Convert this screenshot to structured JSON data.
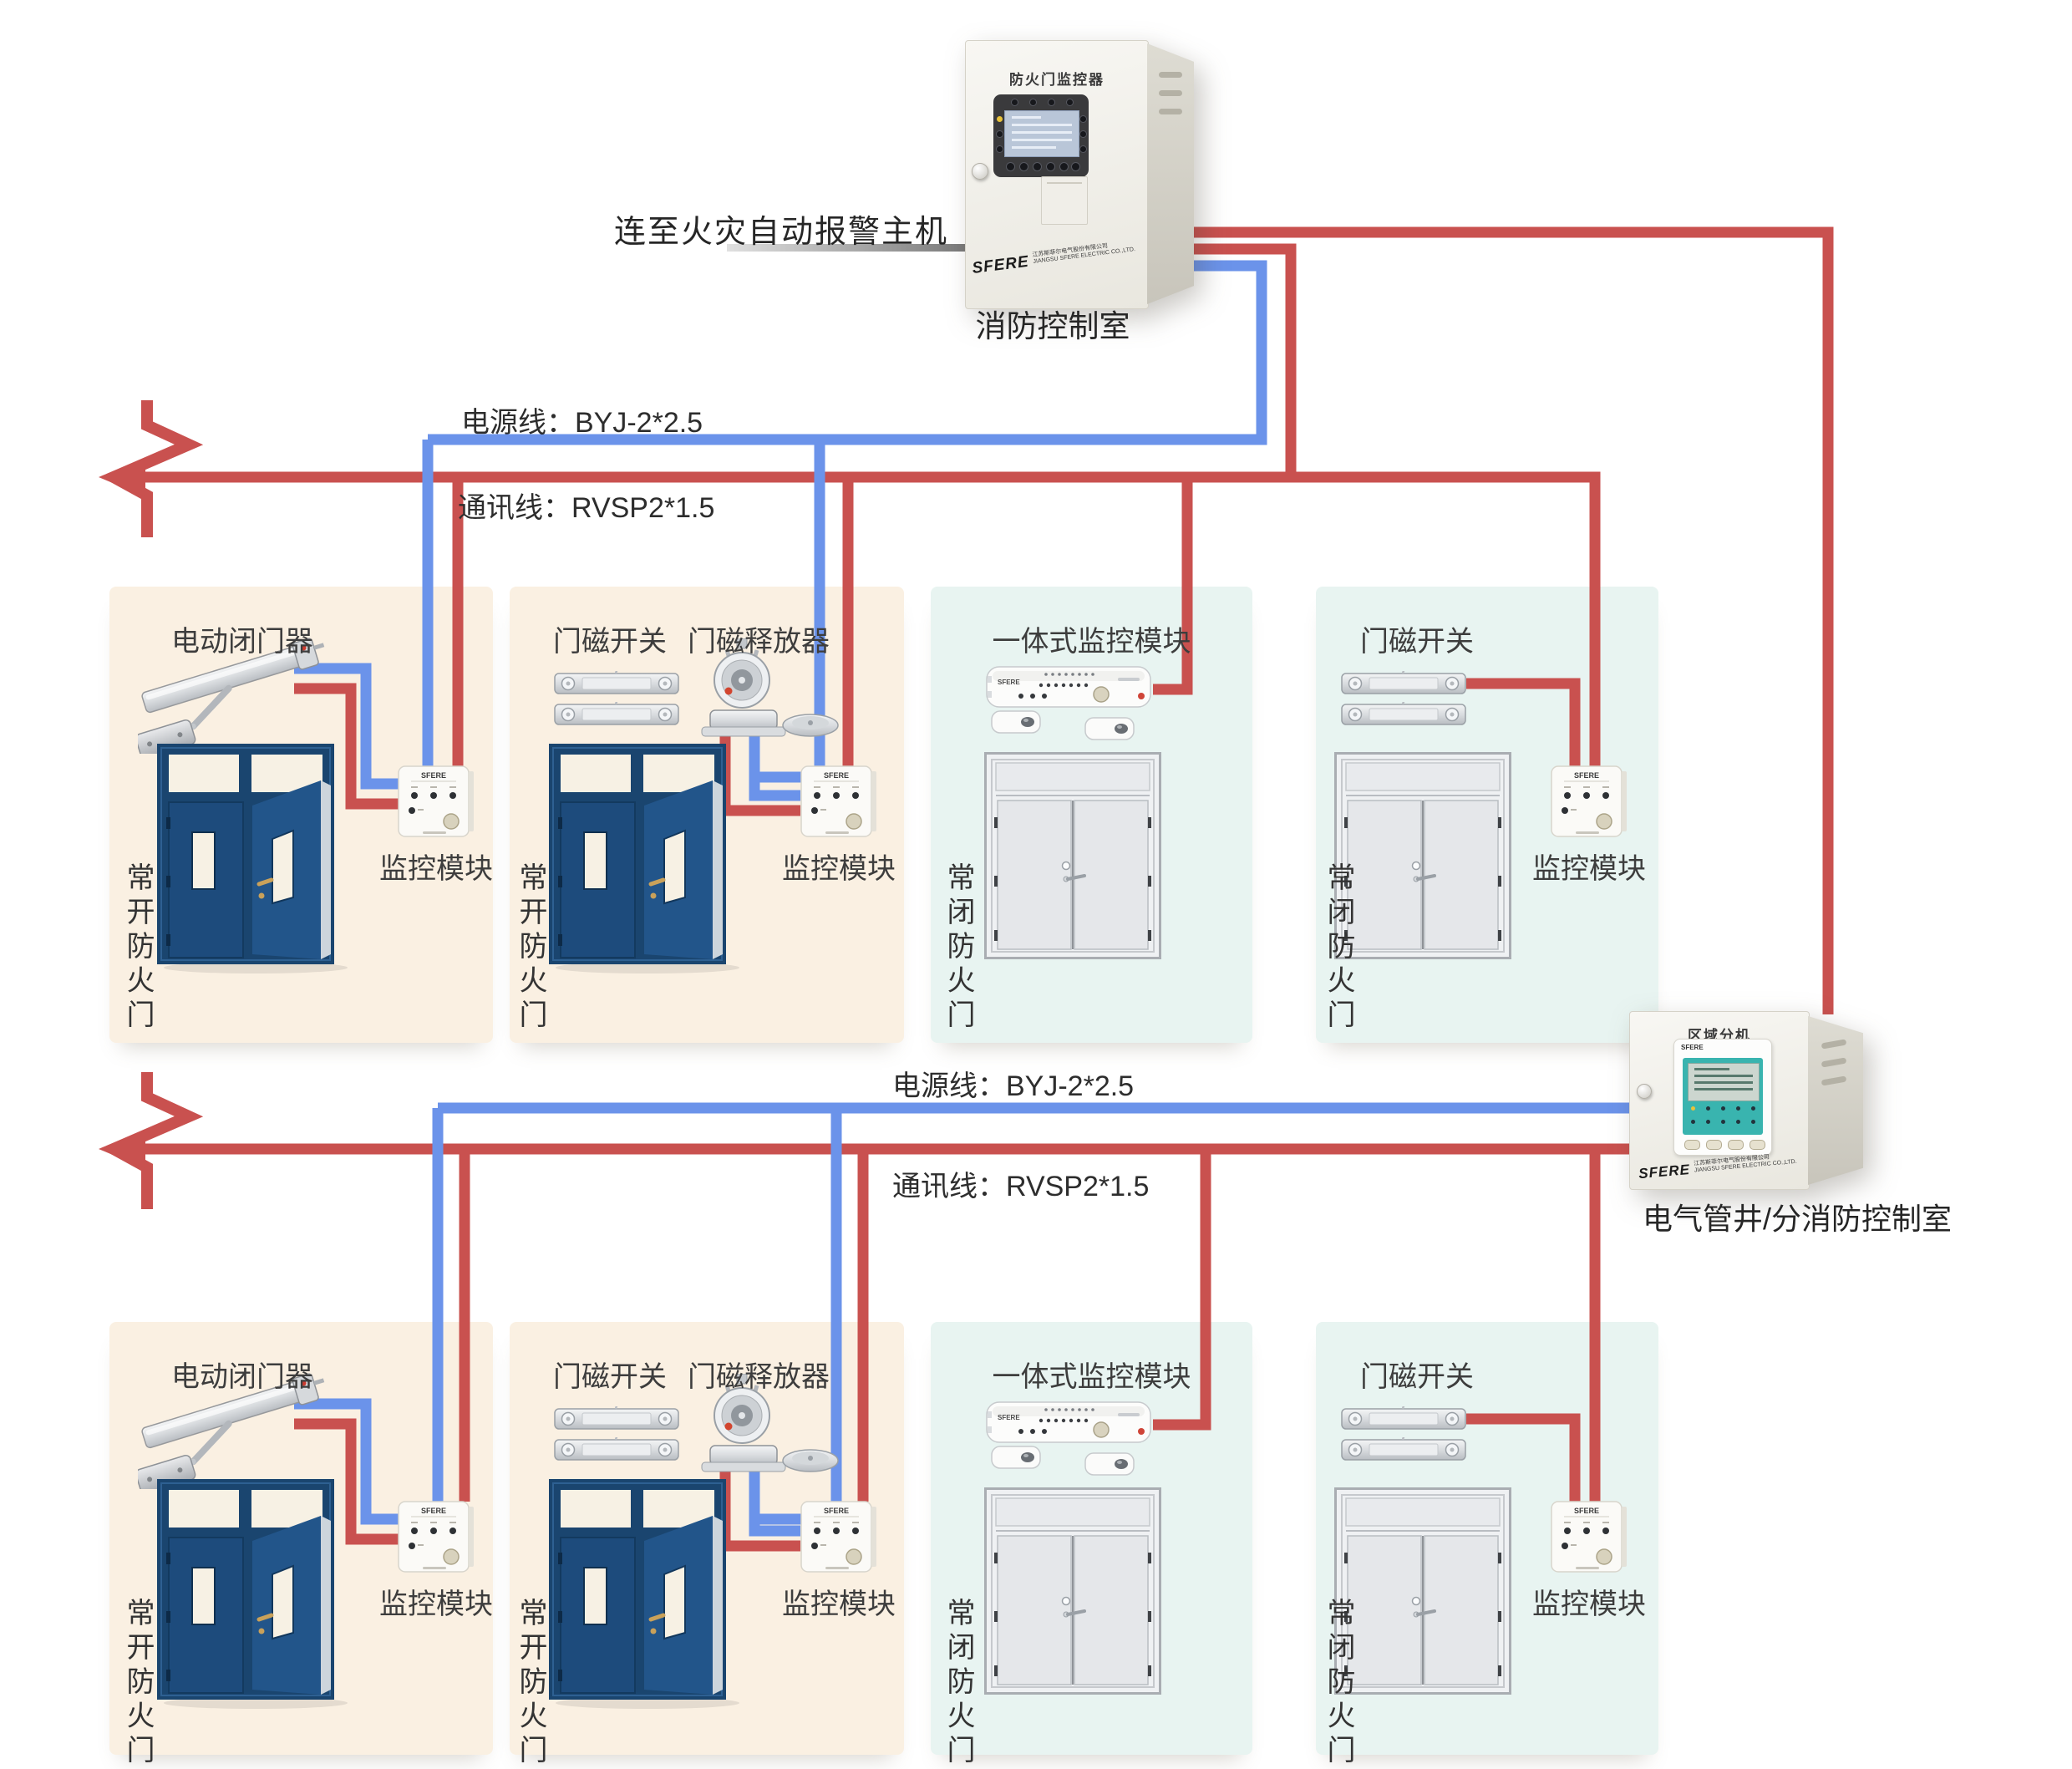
{
  "colors": {
    "wire_red": "#c9514f",
    "wire_blue": "#6b93ea",
    "panel_warm": "#faf0e2",
    "panel_cool": "#e8f4f1",
    "door_navy": "#1d4b7c",
    "door_gray": "#eff1f3",
    "screen_teal": "#39b4af"
  },
  "brand": {
    "name": "SFERE"
  },
  "top": {
    "alarm_link_label": "连至火灾自动报警主机",
    "controller": {
      "title": "防火门监控器",
      "caption": "消防控制室",
      "company_cn": "江苏斯菲尔电气股份有限公司",
      "company_en": "JIANGSU SFERE ELECTRIC CO.,LTD."
    }
  },
  "area_unit": {
    "title": "区域分机",
    "caption": "电气管井/分消防控制室",
    "company_cn": "江苏斯菲尔电气股份有限公司",
    "company_en": "JIANGSU SFERE ELECTRIC CO.,LTD."
  },
  "bus": {
    "row1": {
      "power": "电源线：BYJ-2*2.5",
      "comm": "通讯线：RVSP2*1.5"
    },
    "row2": {
      "power": "电源线：BYJ-2*2.5",
      "comm": "通讯线：RVSP2*1.5"
    }
  },
  "rows": [
    {
      "panels": [
        {
          "title": "电动闭门器",
          "door_label": "常开防火门",
          "module_label": "监控模块"
        },
        {
          "title": "门磁开关",
          "title2": "门磁释放器",
          "door_label": "常开防火门",
          "module_label": "监控模块"
        },
        {
          "title": "一体式监控模块",
          "door_label": "常闭防火门"
        },
        {
          "title": "门磁开关",
          "door_label": "常闭防火门",
          "module_label": "监控模块"
        }
      ]
    },
    {
      "panels": [
        {
          "title": "电动闭门器",
          "door_label": "常开防火门",
          "module_label": "监控模块"
        },
        {
          "title": "门磁开关",
          "title2": "门磁释放器",
          "door_label": "常开防火门",
          "module_label": "监控模块"
        },
        {
          "title": "一体式监控模块",
          "door_label": "常闭防火门"
        },
        {
          "title": "门磁开关",
          "door_label": "常闭防火门",
          "module_label": "监控模块"
        }
      ]
    }
  ]
}
